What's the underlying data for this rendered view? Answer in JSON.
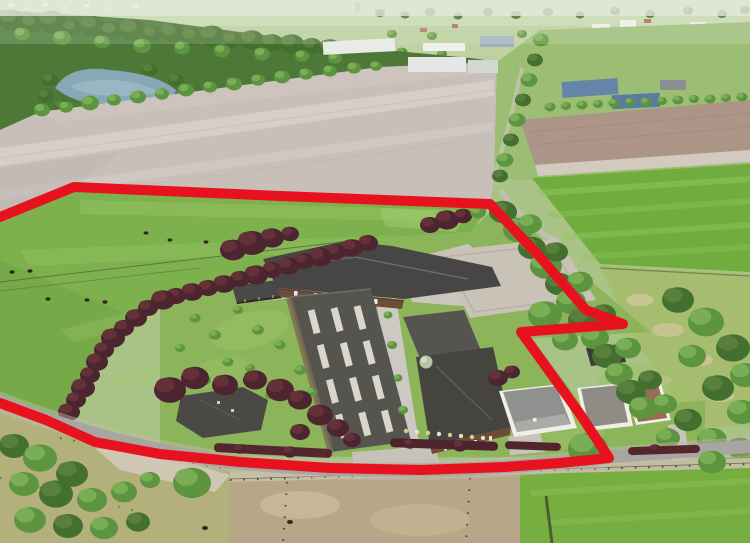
{
  "image": {
    "type": "aerial-photograph",
    "width": 750,
    "height": 543,
    "subject": "Aerial drone photo of a rural equestrian farm estate with surrounding fields; the plot for sale is outlined with a thick red boundary line"
  },
  "boundary": {
    "color": "#e8121f",
    "stroke_width": 10,
    "points": "0,217 74,187 280,196 490,204 540,257 586,310 623,324 521,332 547,368 580,414 609,458 560,463 505,467 420,470 330,468 240,462 160,454 95,442 46,420 0,403"
  },
  "palette": {
    "pasture_green": "#7db14d",
    "lawn_green": "#8cb45b",
    "plowed_field": "#c8bfb9",
    "crop_field_green": "#70ad3e",
    "rough_field": "#a6bd6f",
    "roof_dark": "#474645",
    "arena_roof": "#56544f",
    "road_gray": "#a8a6a1",
    "sand_arena": "#c9c2b6",
    "copper_beech": "#4c2530",
    "tree_green": "#5d9440",
    "water": "#87a8b6",
    "haze": "#e6ecdf",
    "wood_wall": "#6f4c38",
    "white_house": "#efeee8"
  }
}
